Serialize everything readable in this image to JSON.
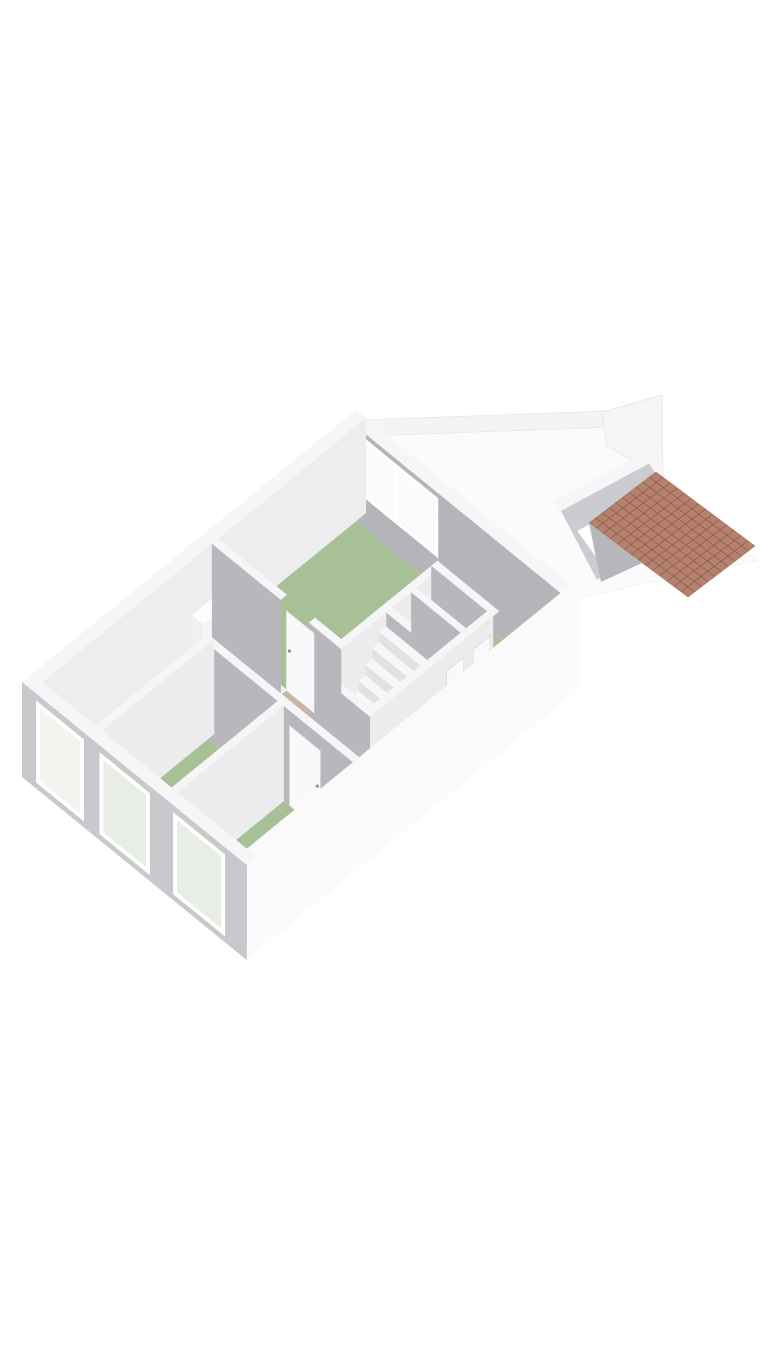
{
  "meta": {
    "title": "3D isometric floor plan",
    "aria_label": "3D isometric floor plan rendering with white walls, green room floors, staircase and tiled shed roof",
    "background": "#ffffff"
  },
  "colors": {
    "wall_top": "#f6f6f8",
    "wall_top_bright": "#fafafb",
    "face_gray": "#b8b8bc",
    "face_gray_accent": "#b4b5b9",
    "face_inner_light": "#ededef",
    "ext_sw": "#c9c9cd",
    "ext_se": "#fbfbfd",
    "floor_white": "#f3f3f5",
    "floor_green": "#a8c096",
    "mat_tan": "#c8b7a0",
    "door_white": "#f9f9fb",
    "glass_green": "#e8eee5",
    "glass_light": "#fafbfc",
    "roof_base": "#b5816c",
    "roof_line": "rgba(110,60,45,0.5)",
    "step_front": "#e2e2e5",
    "step_top": "#f7f7f9",
    "shed_face": "#ccccd0",
    "soft_edge": "#e8e8ec"
  },
  "scene": {
    "origin": [
      22,
      777
    ],
    "ux": 0.775,
    "uy": 0.6315,
    "wall_height": 95,
    "items": [
      {
        "n": "yard-ground",
        "t": "poly",
        "pts": [
          [
            366,
            428
          ],
          [
            604,
            420
          ],
          [
            757,
            560
          ],
          [
            582,
            597
          ]
        ],
        "f": "#fbfbfd",
        "s": "#efeff3"
      },
      {
        "n": "yard-boundary-wall",
        "t": "poly",
        "pts": [
          [
            360,
            420
          ],
          [
            606,
            411
          ],
          [
            613,
            427
          ],
          [
            367,
            436
          ]
        ],
        "f": "#f4f4f6",
        "s": "#e6e6ea"
      },
      {
        "n": "shed-northwest-wall",
        "t": "poly",
        "pts": [
          [
            602,
            412
          ],
          [
            662,
            395
          ],
          [
            663,
            477
          ],
          [
            607,
            446
          ]
        ],
        "f": "#f5f5f7",
        "s": "#e4e4e8"
      },
      {
        "n": "shed-southwest-wall",
        "t": "poly",
        "pts": [
          [
            558,
            505
          ],
          [
            646,
            458
          ],
          [
            685,
            524
          ],
          [
            597,
            580
          ]
        ],
        "f": "#ccccd0"
      },
      {
        "n": "shed-wall-top-band",
        "t": "poly",
        "pts": [
          [
            554,
            501
          ],
          [
            643,
            453
          ],
          [
            650,
            463
          ],
          [
            561,
            511
          ]
        ],
        "f": "#f6f6f8"
      },
      {
        "n": "shed-window-opening",
        "t": "poly",
        "pts": [
          [
            577,
            531
          ],
          [
            620,
            507
          ],
          [
            640,
            533
          ],
          [
            596,
            557
          ]
        ],
        "f": "#ffffff",
        "s": "#dcdce0"
      },
      {
        "n": "shed-roof-tiles",
        "t": "roof",
        "pts": [
          [
            656,
            472
          ],
          [
            755,
            546
          ],
          [
            688,
            597
          ],
          [
            589,
            523
          ]
        ],
        "nu": 14,
        "nv": 10,
        "f": "#b5816c",
        "line": "rgba(110,60,45,0.5)"
      },
      {
        "n": "roof-shadow-wedge",
        "t": "poly",
        "pts": [
          [
            589,
            523
          ],
          [
            642,
            563
          ],
          [
            601,
            582
          ]
        ],
        "f": "#b7b7bb"
      },
      {
        "n": "house-floor",
        "t": "floor",
        "r": [
          13,
          418,
          13,
          277
        ],
        "f": "#f3f3f5"
      },
      {
        "n": "living-room-floor",
        "t": "floor",
        "r": [
          240,
          418,
          13,
          172
        ],
        "f": "#a8c096"
      },
      {
        "n": "living-room-floor-ext",
        "t": "floor",
        "r": [
          356,
          418,
          172,
          277
        ],
        "f": "#a8c096"
      },
      {
        "n": "bedroom2-floor",
        "t": "floor",
        "r": [
          13,
          150,
          90,
          180
        ],
        "f": "#a8c096"
      },
      {
        "n": "bedroom3-floor",
        "t": "floor",
        "r": [
          13,
          150,
          188,
          277
        ],
        "f": "#a8c096"
      },
      {
        "n": "entrance-door-mat",
        "t": "floor",
        "r": [
          226,
          246,
          102,
          138
        ],
        "f": "#c8b7a0"
      },
      {
        "n": "northeast-exterior-wall",
        "t": "prism",
        "r": [
          418,
          431,
          0,
          290
        ],
        "top": "#f6f6f8",
        "left": "#b4b5b9"
      },
      {
        "n": "living-room-window",
        "t": "decal",
        "plane": "a",
        "c": 418,
        "frame": [
          15,
          119,
          30,
          90
        ],
        "ff": "#ffffff",
        "panes": [
          [
            19,
            62,
            34,
            86
          ],
          [
            66,
            115,
            34,
            86
          ]
        ],
        "f": "#fafbfc"
      },
      {
        "n": "northwest-exterior-wall",
        "t": "prism",
        "r": [
          0,
          431,
          0,
          13
        ],
        "top": "#f6f6f8",
        "right": "#ededef"
      },
      {
        "n": "radiator",
        "t": "prism",
        "r": [
          206,
          246,
          13,
          27
        ],
        "z": [
          0,
          40
        ],
        "top": "#fdfdfe",
        "left": "#f0f0f2",
        "right": "#f5f5f6"
      },
      {
        "n": "living-hall-partition-wall",
        "t": "prism",
        "r": [
          197,
          364,
          172,
          180
        ],
        "top": "#f6f6f8",
        "right": "#ececee"
      },
      {
        "n": "bathroom-side-wall",
        "t": "prism",
        "r": [
          356,
          364,
          172,
          252
        ],
        "top": "#f6f6f8",
        "left": "#b8b8bc"
      },
      {
        "n": "bathroom-left-wall",
        "t": "prism",
        "r": [
          290,
          298,
          180,
          244
        ],
        "top": "#f6f6f8",
        "left": "#b8b8bc"
      },
      {
        "n": "bathroom-middle-wall",
        "t": "prism",
        "r": [
          322,
          329,
          180,
          244
        ],
        "top": "#f6f6f8",
        "left": "#b8b8bc"
      },
      {
        "n": "staircase",
        "t": "stairs",
        "a_top": 277,
        "n_steps": 8,
        "depth": 9,
        "b1": 184,
        "b2": 240,
        "z_top": 86,
        "rise": 10.5,
        "top": "#f7f7f9",
        "front": "#e2e2e5"
      },
      {
        "n": "hall-south-wall",
        "t": "prism",
        "r": [
          197,
          356,
          244,
          252
        ],
        "top": "#f6f6f8",
        "right": "#ececee"
      },
      {
        "n": "bathroom-door",
        "t": "door",
        "plane": "b",
        "c": 252,
        "t1": 296,
        "t2": 318,
        "z1": 0,
        "z2": 78,
        "f": "#f9f9fb",
        "handle": [
          315,
          40
        ]
      },
      {
        "n": "toilet-door",
        "t": "door",
        "plane": "b",
        "c": 252,
        "t1": 330,
        "t2": 352,
        "z1": 0,
        "z2": 78,
        "f": "#f9f9fb",
        "handle": [
          349,
          40
        ]
      },
      {
        "n": "stairwell-wall",
        "t": "prism",
        "r": [
          197,
          205,
          180,
          252
        ],
        "top": "#f6f6f8",
        "left": "#b8b8bc"
      },
      {
        "n": "hall-living-wall-a",
        "t": "prism",
        "r": [
          232,
          240,
          13,
          102
        ],
        "top": "#f6f6f8",
        "left": "#b8b8bc"
      },
      {
        "n": "hall-living-wall-b",
        "t": "prism",
        "r": [
          232,
          240,
          138,
          180
        ],
        "top": "#f6f6f8",
        "left": "#b8b8bc"
      },
      {
        "n": "living-room-door",
        "t": "door",
        "plane": "a",
        "c": 239,
        "t1": 102,
        "t2": 138,
        "z1": 0,
        "z2": 80,
        "f": "#f9f9fb",
        "handle": [
          106,
          42
        ]
      },
      {
        "n": "bedroom-hall-wall",
        "t": "prism",
        "r": [
          150,
          158,
          90,
          277
        ],
        "top": "#f6f6f8",
        "left": "#b8b8bc"
      },
      {
        "n": "bedroom3-door",
        "t": "door",
        "plane": "a",
        "c": 150,
        "t1": 195,
        "t2": 235,
        "z1": 0,
        "z2": 80,
        "f": "#f9f9fb",
        "handle": [
          231,
          42
        ]
      },
      {
        "n": "bedroom2-north-wall",
        "t": "prism",
        "r": [
          13,
          158,
          82,
          90
        ],
        "top": "#f6f6f8",
        "right": "#ececee"
      },
      {
        "n": "bedroom-divider-wall",
        "t": "prism",
        "r": [
          13,
          150,
          180,
          188
        ],
        "top": "#f6f6f8",
        "right": "#ececee"
      },
      {
        "n": "southeast-exterior-wall",
        "t": "prism",
        "r": [
          0,
          431,
          277,
          290
        ],
        "top": "#fafafb",
        "right": "#fbfbfd"
      },
      {
        "n": "southwest-exterior-wall",
        "t": "prism",
        "r": [
          0,
          13,
          0,
          290
        ],
        "top": "#f6f6f8",
        "left": "#c9c9cd"
      },
      {
        "n": "hall-window",
        "t": "decal",
        "plane": "a",
        "c": 0,
        "frame": [
          18,
          80,
          6,
          88
        ],
        "ff": "#ffffff",
        "panes": [
          [
            23,
            75,
            11,
            83
          ]
        ],
        "f": "#f2f4f0"
      },
      {
        "n": "bedroom2-window",
        "t": "decal",
        "plane": "a",
        "c": 0,
        "frame": [
          100,
          165,
          6,
          88
        ],
        "ff": "#ffffff",
        "panes": [
          [
            105,
            160,
            11,
            83
          ]
        ],
        "f": "#e8eee5"
      },
      {
        "n": "bedroom3-window",
        "t": "decal",
        "plane": "a",
        "c": 0,
        "frame": [
          195,
          262,
          6,
          88
        ],
        "ff": "#ffffff",
        "panes": [
          [
            200,
            257,
            11,
            83
          ]
        ],
        "f": "#e8eee5"
      }
    ]
  }
}
